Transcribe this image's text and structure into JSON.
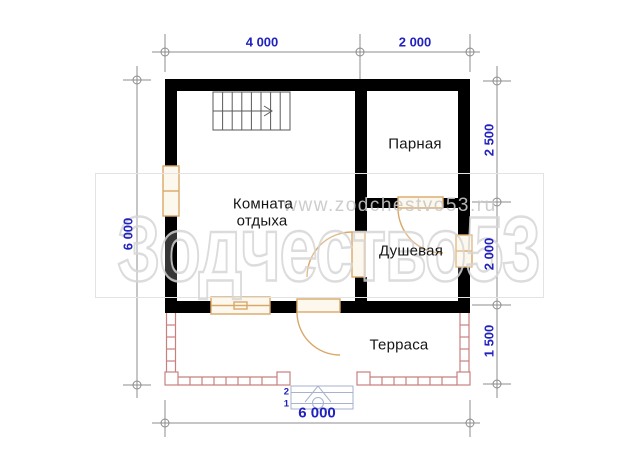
{
  "rooms": {
    "rest": {
      "line1": "Комната",
      "line2": "отдыха"
    },
    "steam": "Парная",
    "shower": "Душевая",
    "terrace": "Терраса"
  },
  "dimensions": {
    "top_left": "4 000",
    "top_right": "2 000",
    "left": "6 000",
    "right_top": "2 500",
    "right_middle": "2 000",
    "right_bottom": "1 500",
    "bottom": "6 000"
  },
  "entry_steps": {
    "step2": "2",
    "step1": "1"
  },
  "watermark": {
    "text": "Зодчество53",
    "url": "www.zodchestvo53.ru"
  },
  "colors": {
    "wall": "#000000",
    "joinery": "#D9A869",
    "joinery_fill": "#FDF8EE",
    "terrace_outline": "#C8807E",
    "dimension_text": "#2121BD",
    "dimension_line": "#8C8C8C",
    "stairs_line": "#5A5A5A",
    "entry_steps_line": "#A6B2CE",
    "watermark_gray": "#C8C8C8"
  }
}
